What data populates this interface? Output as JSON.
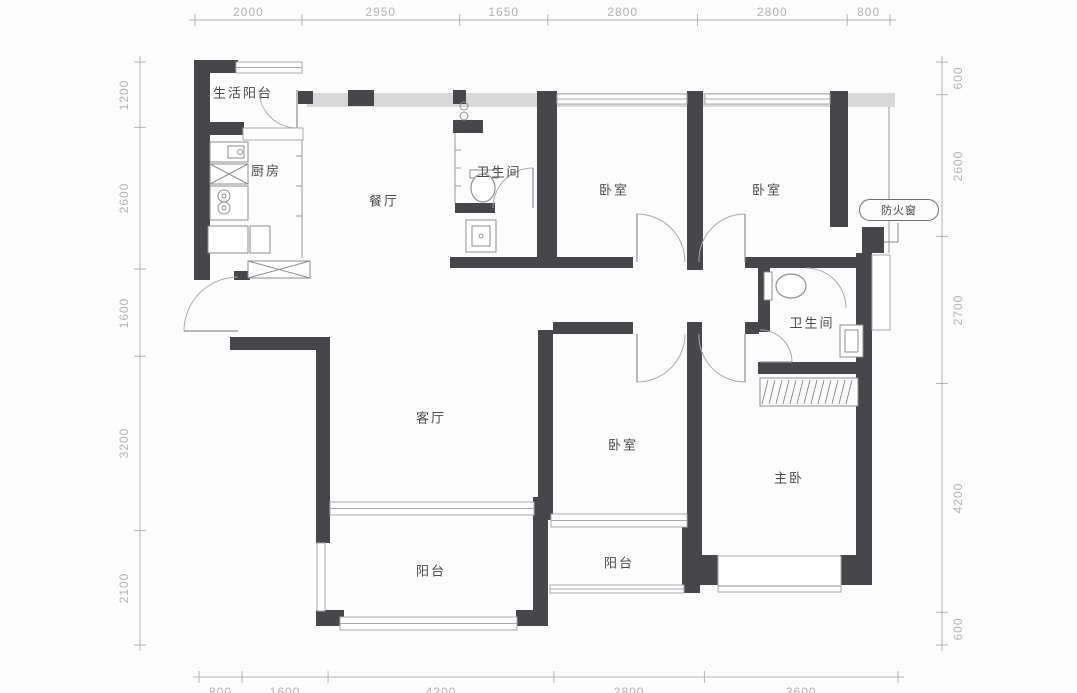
{
  "plan": {
    "annotation_fire_window": "防火窗",
    "rooms": [
      {
        "id": "service-balcony",
        "label": "生活阳台"
      },
      {
        "id": "kitchen",
        "label": "厨房"
      },
      {
        "id": "dining-room",
        "label": "餐厅"
      },
      {
        "id": "bathroom-1",
        "label": "卫生间"
      },
      {
        "id": "bedroom-1",
        "label": "卧室"
      },
      {
        "id": "bedroom-2",
        "label": "卧室"
      },
      {
        "id": "bathroom-2",
        "label": "卫生间"
      },
      {
        "id": "living-room",
        "label": "客厅"
      },
      {
        "id": "bedroom-3",
        "label": "卧室"
      },
      {
        "id": "master-bedroom",
        "label": "主卧"
      },
      {
        "id": "balcony-1",
        "label": "阳台"
      },
      {
        "id": "balcony-2",
        "label": "阳台"
      }
    ],
    "dimensions": {
      "top": [
        "2000",
        "2950",
        "1650",
        "2800",
        "2800",
        "800"
      ],
      "bottom": [
        "800",
        "1600",
        "4200",
        "2800",
        "3600"
      ],
      "left": [
        "1200",
        "2600",
        "1600",
        "3200",
        "2100"
      ],
      "right": [
        "600",
        "2600",
        "2700",
        "4200",
        "600"
      ]
    },
    "colors": {
      "wall": "#47474b",
      "fixture_line": "#8e8e92",
      "thin_line": "#a8a8ac",
      "band": "#d8d8d8",
      "dim_line": "#b5b5b5",
      "dim_text": "#b2b2b2",
      "label_text": "#4a4a4e"
    }
  }
}
